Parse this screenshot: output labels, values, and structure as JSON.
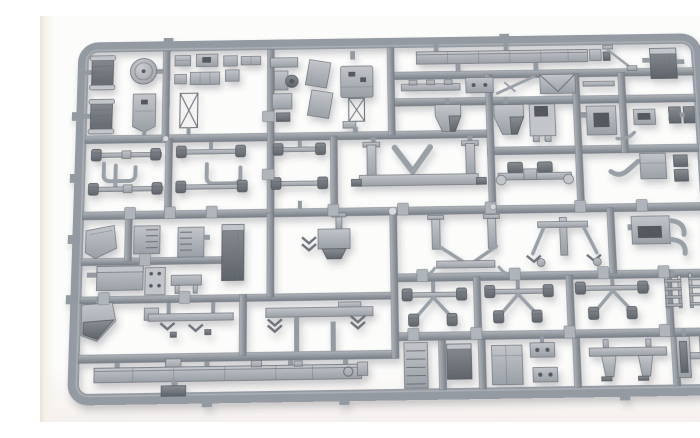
{
  "image": {
    "alt": "Injection-moulded plastic model kit sprue (runner frame) filled with unpainted grey vehicle parts, photographed on a white background"
  },
  "colors": {
    "background": "#fcfcfb",
    "paper_edge_left": "#e9e2d6",
    "paper_edge_right": "#f3e6e2",
    "runner": "#949aa2",
    "runner_light": "#b0b5bb",
    "runner_dark": "#787e86",
    "part_light": "#c2c5ca",
    "part_mid": "#9aa0a7",
    "part_dark": "#6e737a",
    "part_darkest": "#54585e",
    "highlight": "#d8dbde",
    "shadow": "#3a4048"
  },
  "sprue": {
    "frame_shape": "rounded-rectangle runner frame, slightly tilted, grey styrene",
    "part_groups": [
      "exhaust-cylinder",
      "pulley-disc",
      "cab-back-shield",
      "x-brace-frame",
      "small-fittings",
      "bracket-assembly",
      "slanted-panels",
      "box-on-tower",
      "long-roof-beam",
      "diagonal-rod",
      "dark-storage-box",
      "leaf-spring",
      "flat-plate",
      "diagonal-brace",
      "v-plate",
      "hopper-cab-part",
      "white-face-box",
      "dark-center-box",
      "side-boxes",
      "crossmember-with-posts",
      "driveshaft",
      "u-shaped-tube",
      "axle-with-drums",
      "seat-and-boot",
      "chevron-hopper",
      "h-frame-crossmember",
      "arm-assembly",
      "fender-with-hooks",
      "mudguard-wedge",
      "ribbed-engine-box",
      "tall-fuel-tank",
      "storage-box",
      "holes-plate",
      "prong-bracket",
      "front-wedge",
      "tow-hitch-bar",
      "chevron-crossmember",
      "chassis-rail",
      "ribbed-radiator",
      "plain-box",
      "rivet-plate",
      "crossmember-with-legs",
      "channel-bars",
      "ladder-piece",
      "x-driveshaft-cluster",
      "part-number-tag",
      "ejector-pin-mark"
    ]
  }
}
